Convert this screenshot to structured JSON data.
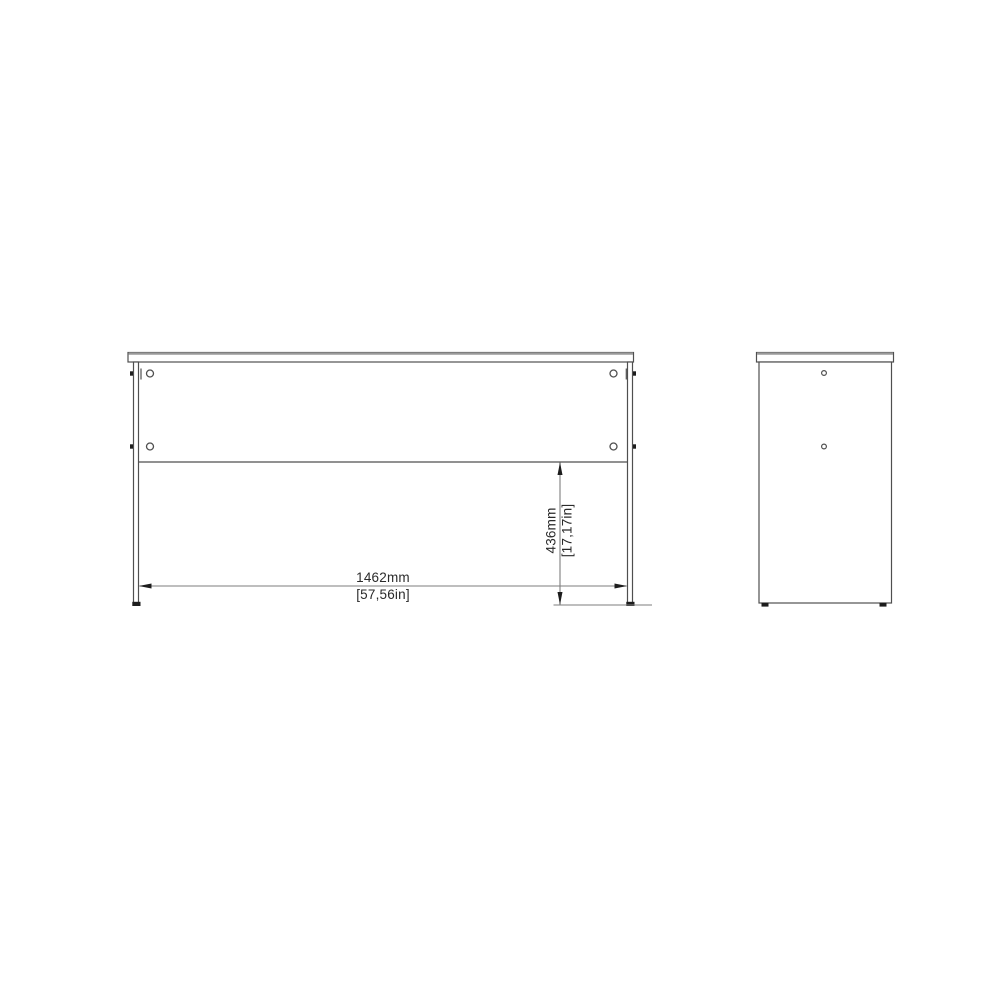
{
  "drawing": {
    "type": "furniture-technical-drawing",
    "dimensions": {
      "width_mm": "1462mm",
      "width_in": "[57,56in]",
      "height_mm": "436mm",
      "height_in": "[17,17in]"
    },
    "colors": {
      "background": "#ffffff",
      "object_line": "#4f4f4f",
      "soft_edge": "#9a9a9a",
      "dimension_line": "#7e7e7e",
      "accent_ink": "#1d1d1d",
      "text": "#2b2b2b"
    }
  }
}
